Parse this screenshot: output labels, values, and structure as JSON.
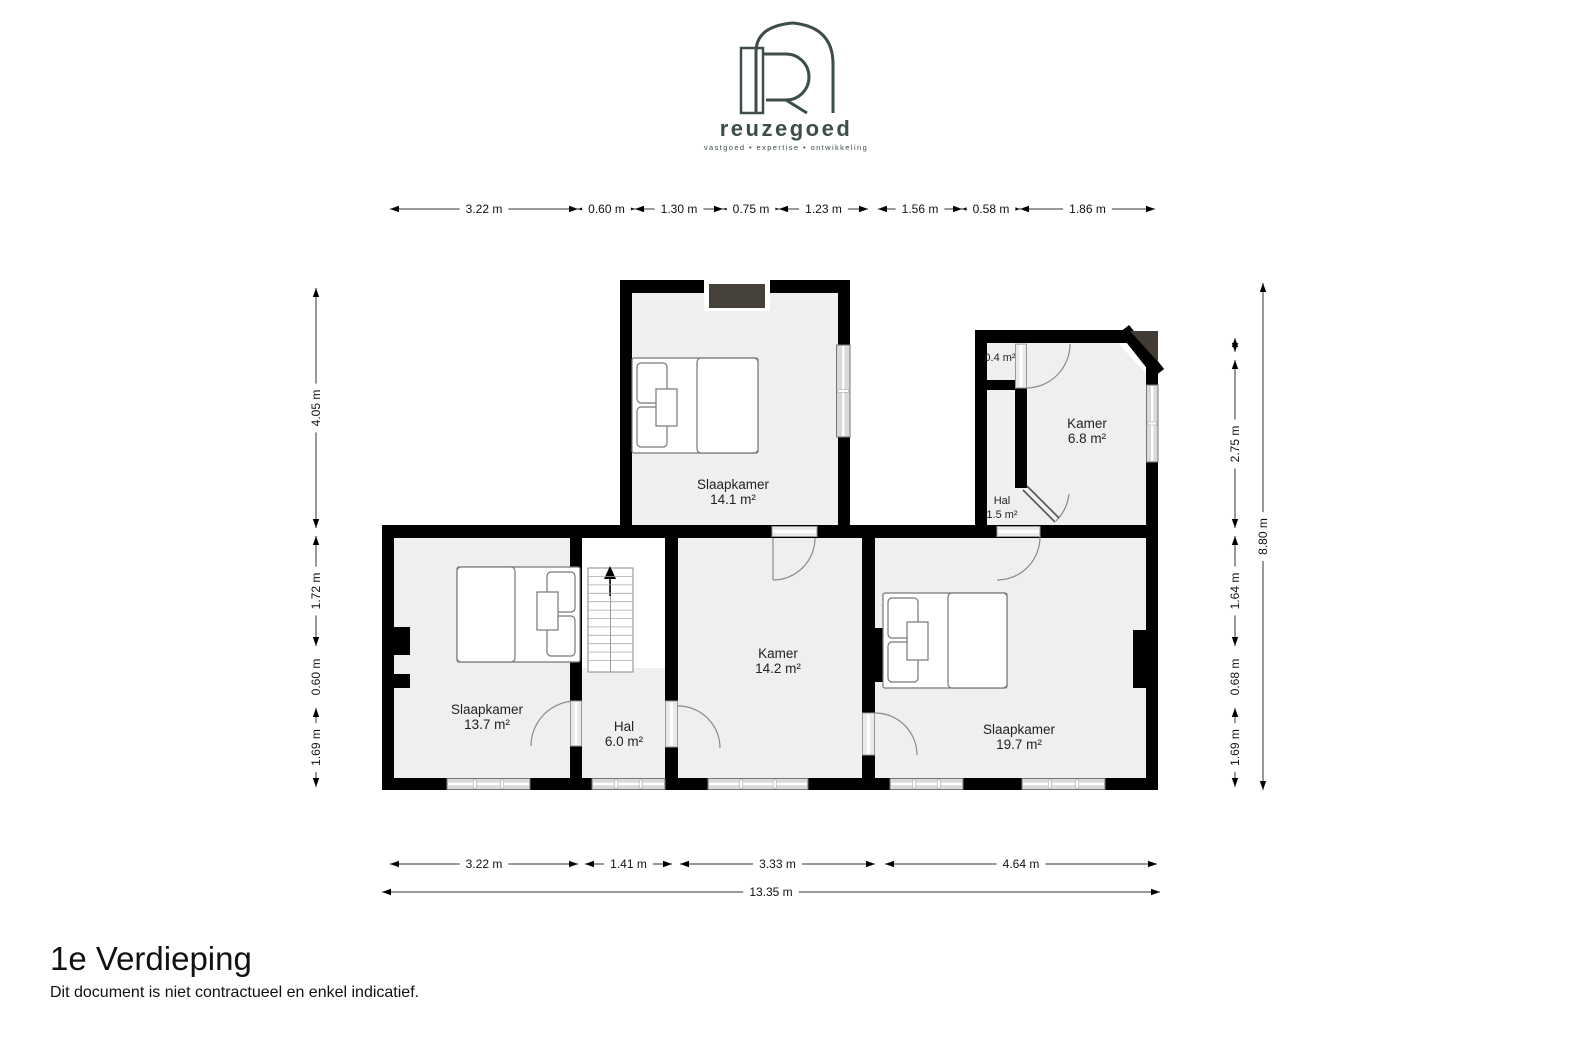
{
  "logo": {
    "brand": "reuzegoed",
    "tagline": "vastgoed • expertise • ontwikkeling",
    "color": "#3d4f44"
  },
  "floor": {
    "title": "1e Verdieping",
    "disclaimer": "Dit document is niet contractueel en enkel indicatief."
  },
  "rooms": {
    "slaapkamer_top": {
      "name": "Slaapkamer",
      "area": "14.1 m²"
    },
    "kamer_right": {
      "name": "Kamer",
      "area": "6.8 m²"
    },
    "hal_small": {
      "name": "Hal",
      "area": "1.5 m²"
    },
    "closet": {
      "area": "0.4 m²"
    },
    "slaapkamer_left": {
      "name": "Slaapkamer",
      "area": "13.7 m²"
    },
    "hal_main": {
      "name": "Hal",
      "area": "6.0 m²"
    },
    "kamer_center": {
      "name": "Kamer",
      "area": "14.2 m²"
    },
    "slaapkamer_right": {
      "name": "Slaapkamer",
      "area": "19.7 m²"
    }
  },
  "dimensions": {
    "top": [
      "3.22 m",
      "0.60 m",
      "1.30 m",
      "0.75 m",
      "1.23 m",
      "1.56 m",
      "0.58 m",
      "1.86 m"
    ],
    "left": [
      "4.05 m",
      "1.72 m",
      "0.60 m",
      "1.69 m"
    ],
    "right_inner": [
      "2.75 m",
      "1.64 m",
      "0.68 m",
      "1.69 m"
    ],
    "right_outer": "8.80 m",
    "bottom": [
      "3.22 m",
      "1.41 m",
      "3.33 m",
      "4.64 m"
    ],
    "bottom_total": "13.35 m"
  },
  "colors": {
    "wall": "#000000",
    "room_fill": "#efefef",
    "chimney": "#46413a",
    "frame_gray": "#d9d9d9"
  }
}
